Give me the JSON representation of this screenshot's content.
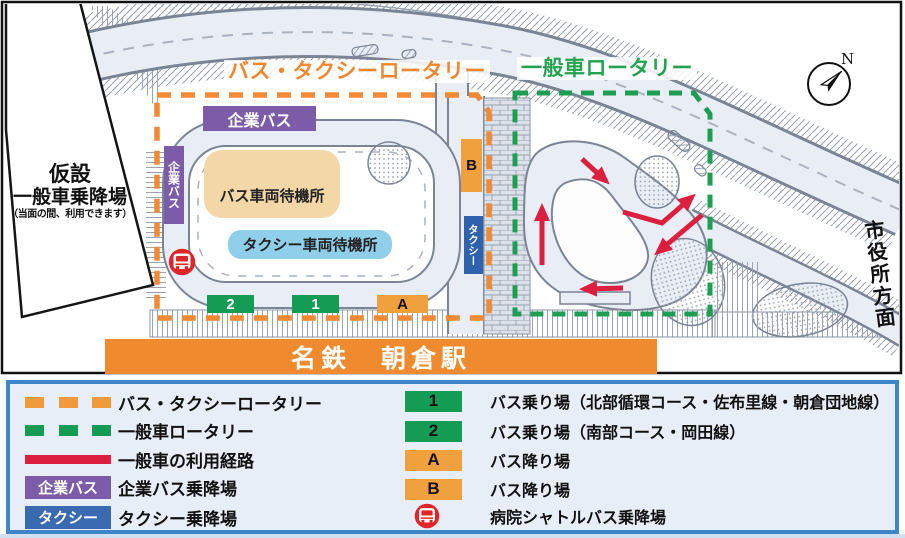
{
  "map": {
    "titles": {
      "bus_taxi_rotary": "バス・タクシーロータリー",
      "general_rotary": "一般車ロータリー"
    },
    "temporary_stop": {
      "line1": "仮設",
      "line2": "一般車乗降場",
      "note": "（当面の間、利用できます）"
    },
    "areas": {
      "corporate_bus_top": "企業バス",
      "corporate_bus_side": "企業バス",
      "bus_wait": "バス車両待機所",
      "taxi_wait": "タクシー車両待機所"
    },
    "stops": {
      "board_1": "1",
      "board_2": "2",
      "alight_a": "A",
      "alight_b": "B",
      "taxi": "タクシー"
    },
    "station_name": "名鉄　朝倉駅",
    "direction_city_hall": "市役所方面",
    "compass_north": "N"
  },
  "legend": {
    "left": [
      {
        "marker": "orange-dash",
        "label": "バス・タクシーロータリー"
      },
      {
        "marker": "green-dash",
        "label": "一般車ロータリー"
      },
      {
        "marker": "red-line",
        "label": "一般車の利用経路"
      },
      {
        "marker": "purple-box",
        "box_label": "企業バス",
        "label": "企業バス乗降場"
      },
      {
        "marker": "blue-box",
        "box_label": "タクシー",
        "label": "タクシー乗降場"
      }
    ],
    "right": [
      {
        "marker": "1",
        "label": "バス乗り場（北部循環コース・佐布里線・朝倉団地線）"
      },
      {
        "marker": "2",
        "label": "バス乗り場（南部コース・岡田線）"
      },
      {
        "marker": "A",
        "label": "バス降り場"
      },
      {
        "marker": "B",
        "label": "バス降り場"
      },
      {
        "marker": "bus-icon",
        "label": "病院シャトルバス乗降場"
      }
    ]
  },
  "colors": {
    "orange_rotary": "#F09A3C",
    "green_rotary": "#1E9E53",
    "red_route": "#DC1F3F",
    "purple_corporate": "#7C5CA8",
    "blue_taxi": "#3A6BB0",
    "orange_station": "#F08A2E",
    "tan_bus_wait": "#F3D7A7",
    "lightblue_taxi_wait": "#8FCFEA",
    "shuttle_icon_red": "#E02528",
    "legend_border": "#3E86C8"
  }
}
